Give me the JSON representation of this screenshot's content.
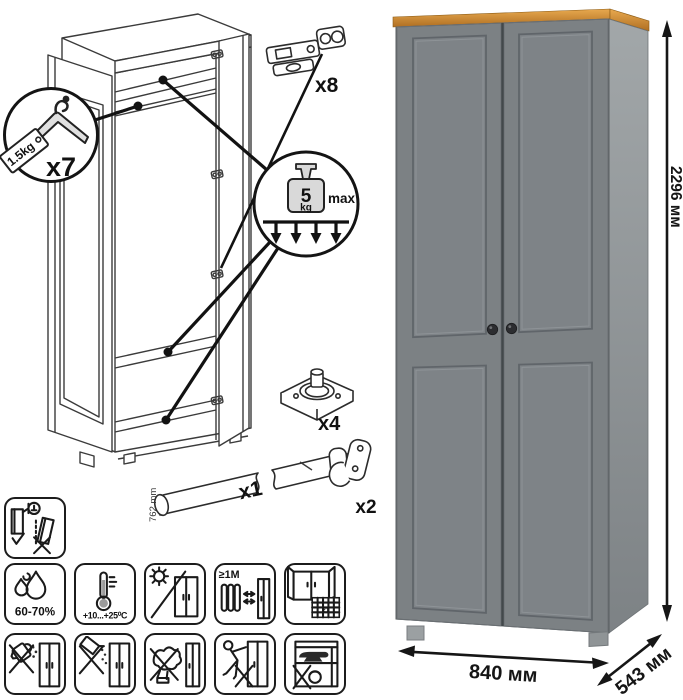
{
  "assembly_diagram": {
    "hanger_callout": {
      "capacity_tag": "1.5kg",
      "count": "x7"
    },
    "load_callout": {
      "weight_value": "5",
      "weight_unit": "kg",
      "limit_label": "max"
    },
    "parts": {
      "hinge_count": "x8",
      "foot_count": "x4",
      "rod_count": "x1",
      "rod_length": "762 mm",
      "hook_count": "x2"
    }
  },
  "product": {
    "dimensions": {
      "height": "2296 мм",
      "width": "840 мм",
      "depth": "543 мм"
    },
    "colors": {
      "door_gray": "#7c8184",
      "panel_gray": "#7e8387",
      "side_gray_top": "#a2a7a9",
      "side_gray_bottom": "#7d8285",
      "top_trim_wood": "#cd8a30",
      "knob": "#2c2d30"
    }
  },
  "care_panel": {
    "humidity_label": "60-70%",
    "temperature_label": "+10...+25⁰C",
    "heat_distance_label": "≥1М",
    "ventilation_day": "21",
    "icons": [
      "anti-tip-anchor-icon",
      "humidity-icon",
      "temperature-icon",
      "no-direct-sunlight-icon",
      "heat-distance-icon",
      "ventilation-icon",
      "no-liquids-icon",
      "no-abrasives-icon",
      "no-solvents-icon",
      "no-dragging-icon",
      "no-heavy-items-icon"
    ]
  }
}
